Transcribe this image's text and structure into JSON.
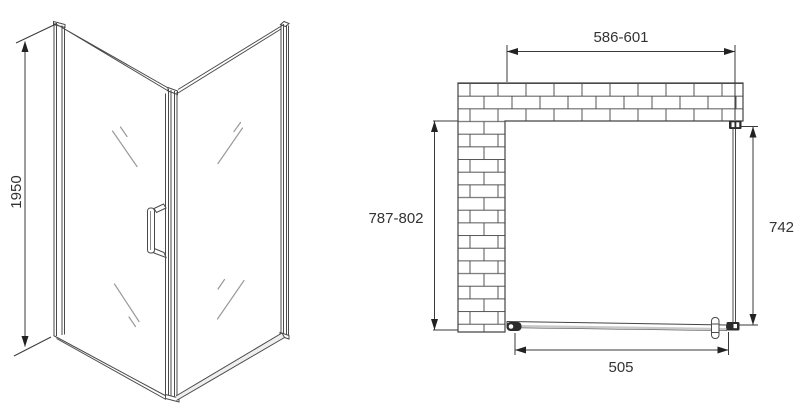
{
  "colors": {
    "background": "#ffffff",
    "line": "#4a4a4a",
    "dark_fittings": "#2b2b2b",
    "dimension_text": "#333333"
  },
  "perspective_view": {
    "height_dim_label": "1950"
  },
  "plan_view": {
    "width_dim_label": "586-601",
    "depth_dim_label": "787-802",
    "side_panel_dim_label": "742",
    "door_dim_label": "505"
  }
}
